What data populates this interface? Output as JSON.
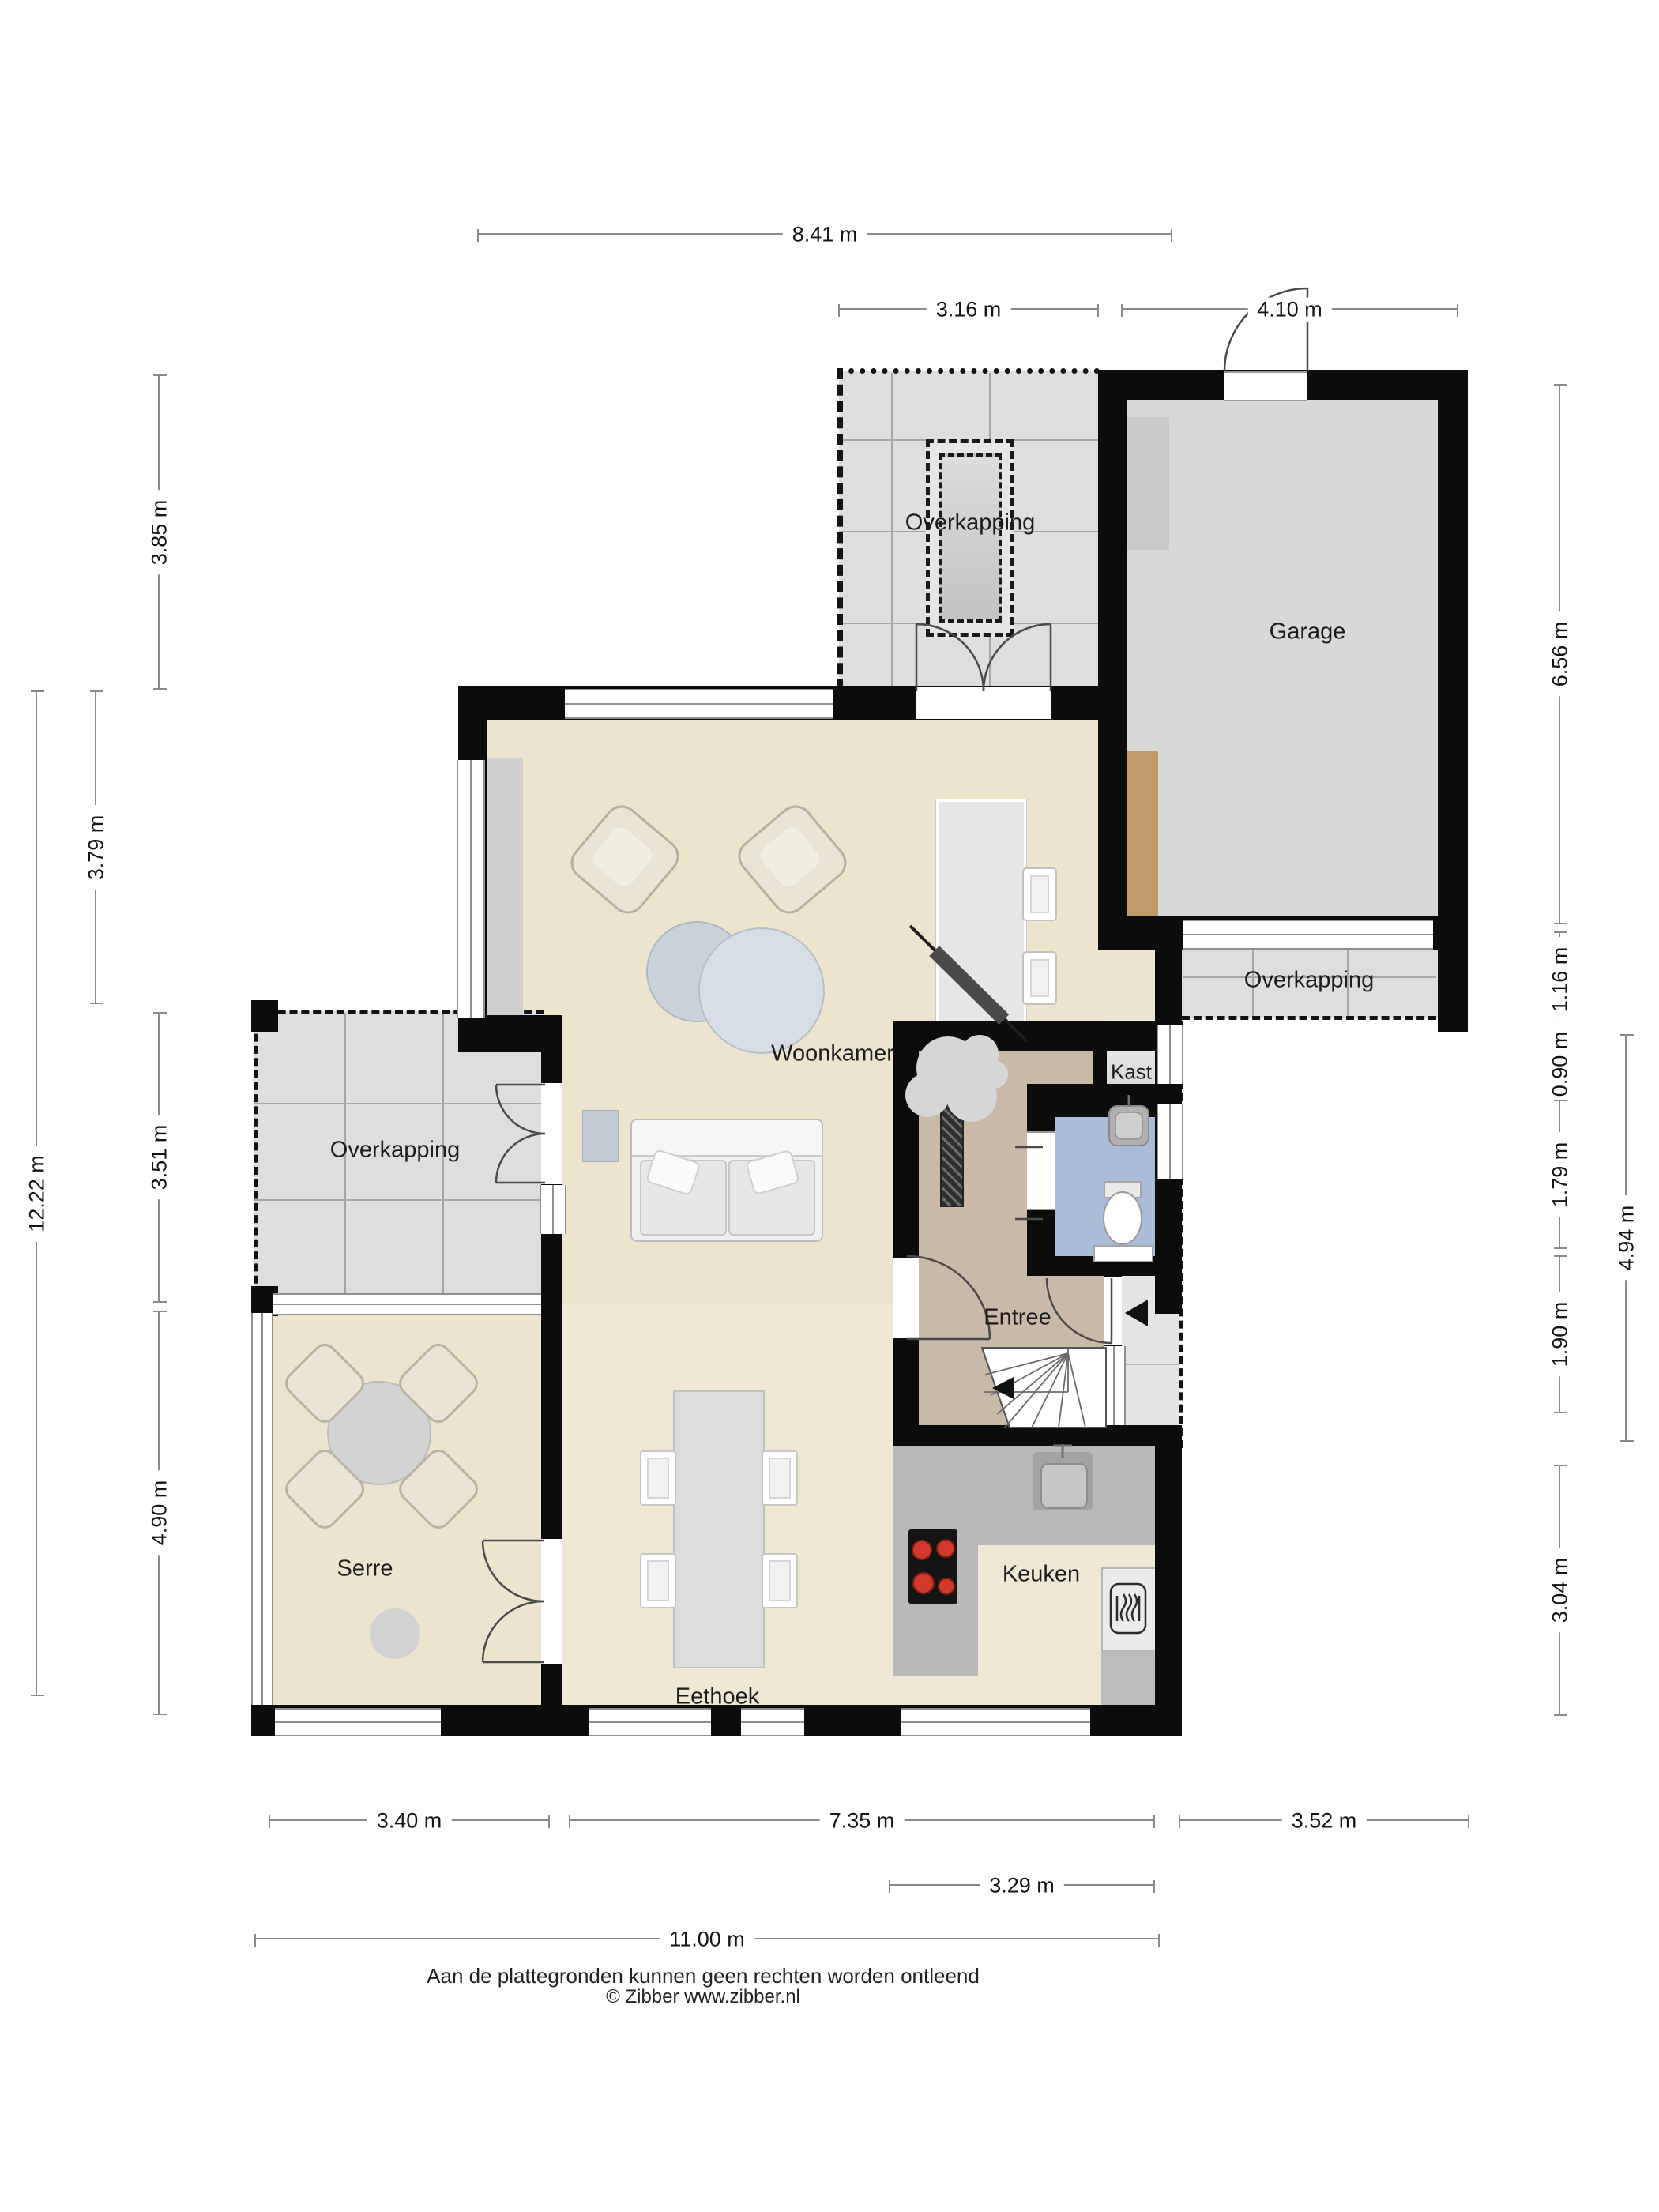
{
  "rooms": {
    "woonkamer": "Woonkamer",
    "serre": "Serre",
    "eethoek": "Eethoek",
    "keuken": "Keuken",
    "entree": "Entree",
    "kast": "Kast",
    "garage": "Garage",
    "overkapping_top": "Overkapping",
    "overkapping_left": "Overkapping",
    "overkapping_right": "Overkapping"
  },
  "dimensions": {
    "top": {
      "d1": "8.41 m",
      "d2": "3.16 m",
      "d3": "4.10 m"
    },
    "left": {
      "d1": "3.85 m",
      "d2": "3.79 m",
      "d3": "3.51 m",
      "d4": "12.22 m",
      "d5": "4.90 m"
    },
    "right": {
      "d1": "6.56 m",
      "d2": "1.16 m",
      "d3": "0.90 m",
      "d4": "1.79 m",
      "d5": "1.90 m",
      "d6": "3.04 m",
      "d7": "4.94 m"
    },
    "bottom": {
      "d1": "3.40 m",
      "d2": "7.35 m",
      "d3": "3.52 m",
      "d4": "3.29 m",
      "d5": "11.00 m"
    }
  },
  "footer": {
    "line1": "Aan de plattegronden kunnen geen rechten worden ontleend",
    "line2": "© Zibber www.zibber.nl"
  },
  "colors": {
    "wall": "#0c0c0c",
    "floor_living": "#ece4cd",
    "floor_entree": "#c9b9a7",
    "floor_toilet": "#a9bdd8",
    "floor_overkapping": "#dedede",
    "floor_garage": "#d8d8d8",
    "counter": "#b9b9b9",
    "wood_cabinet": "#bf9a6a",
    "cooktop_burner": "#d0392c"
  }
}
